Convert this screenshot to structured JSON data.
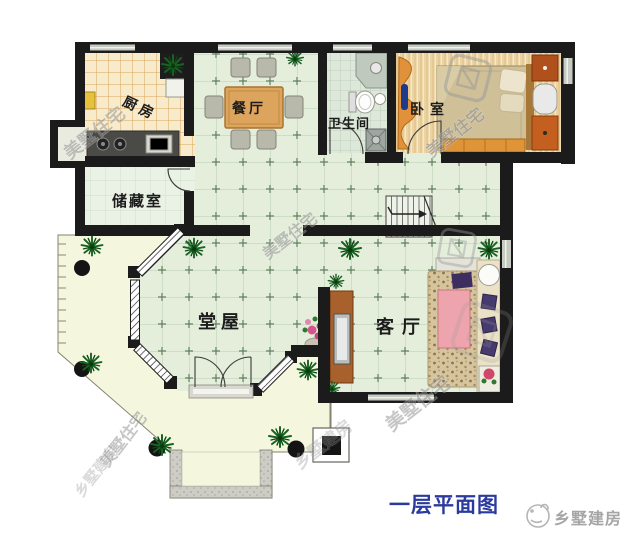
{
  "caption": {
    "text": "一层平面图",
    "color": "#2b3a9e"
  },
  "brand": {
    "name": "乡墅建房",
    "color": "#a5a5a5",
    "logo": "sketch-face-circle"
  },
  "rooms": {
    "kitchen": {
      "label": "厨房"
    },
    "dining": {
      "label": "餐厅"
    },
    "bathroom": {
      "label": "卫生间"
    },
    "bedroom": {
      "label": "卧室"
    },
    "storage": {
      "label": "储藏室"
    },
    "hall": {
      "label": "堂屋"
    },
    "living": {
      "label": "客厅"
    }
  },
  "watermarks": {
    "primary": "美墅住宅",
    "secondary": "乡墅建房"
  },
  "palette": {
    "wall": "#1b1b1b",
    "tile_green": "#e4eedb",
    "kitchen_tile": "#f8ebcb",
    "bedroom_wood": "#f0ddb2",
    "terrace": "#f4f6de",
    "plant_green": "#176322",
    "sofa_pink": "#eda4ac",
    "cabinet_brown": "#a8602c",
    "caption_blue": "#2b3a9e"
  }
}
